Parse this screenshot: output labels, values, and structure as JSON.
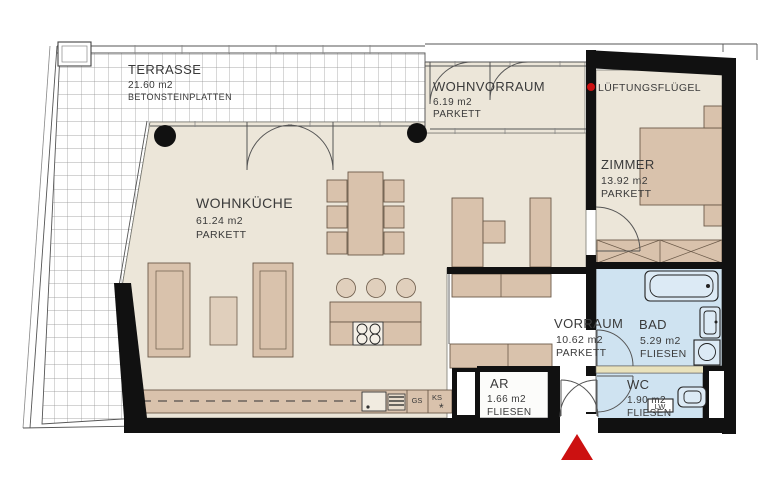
{
  "plan": {
    "rooms": {
      "terrasse": {
        "name": "TERRASSE",
        "area": "21.60 m2",
        "floor": "BETONSTEINPLATTEN"
      },
      "wohnvorraum": {
        "name": "WOHNVORRAUM",
        "area": "6.19 m2",
        "floor": "PARKETT"
      },
      "wohnkueche": {
        "name": "WOHNKÜCHE",
        "area": "61.24 m2",
        "floor": "PARKETT"
      },
      "zimmer": {
        "name": "ZIMMER",
        "area": "13.92 m2",
        "floor": "PARKETT"
      },
      "vorraum": {
        "name": "VORRAUM",
        "area": "10.62 m2",
        "floor": "PARKETT"
      },
      "bad": {
        "name": "BAD",
        "area": "5.29 m2",
        "floor": "FLIESEN"
      },
      "ar": {
        "name": "AR",
        "area": "1.66 m2",
        "floor": "FLIESEN"
      },
      "wc": {
        "name": "WC",
        "area": "1.90 m2",
        "floor": "FLIESEN"
      }
    },
    "annotations": {
      "lueftungsfluegel": "LÜFTUNGSFLÜGEL",
      "dishwasher": "GS",
      "fridge": "KS",
      "fridge_star": "*",
      "wc_vent": "LW"
    },
    "colors": {
      "parquet_floor": "#ece6d9",
      "furniture_tan": "#d9c2ac",
      "tile_blue": "#cfe3f1",
      "fixture_blue": "#dceaf5",
      "wall_black": "#111111",
      "accent_red": "#cc1111",
      "partition_yellow": "#e9e2bc"
    }
  }
}
